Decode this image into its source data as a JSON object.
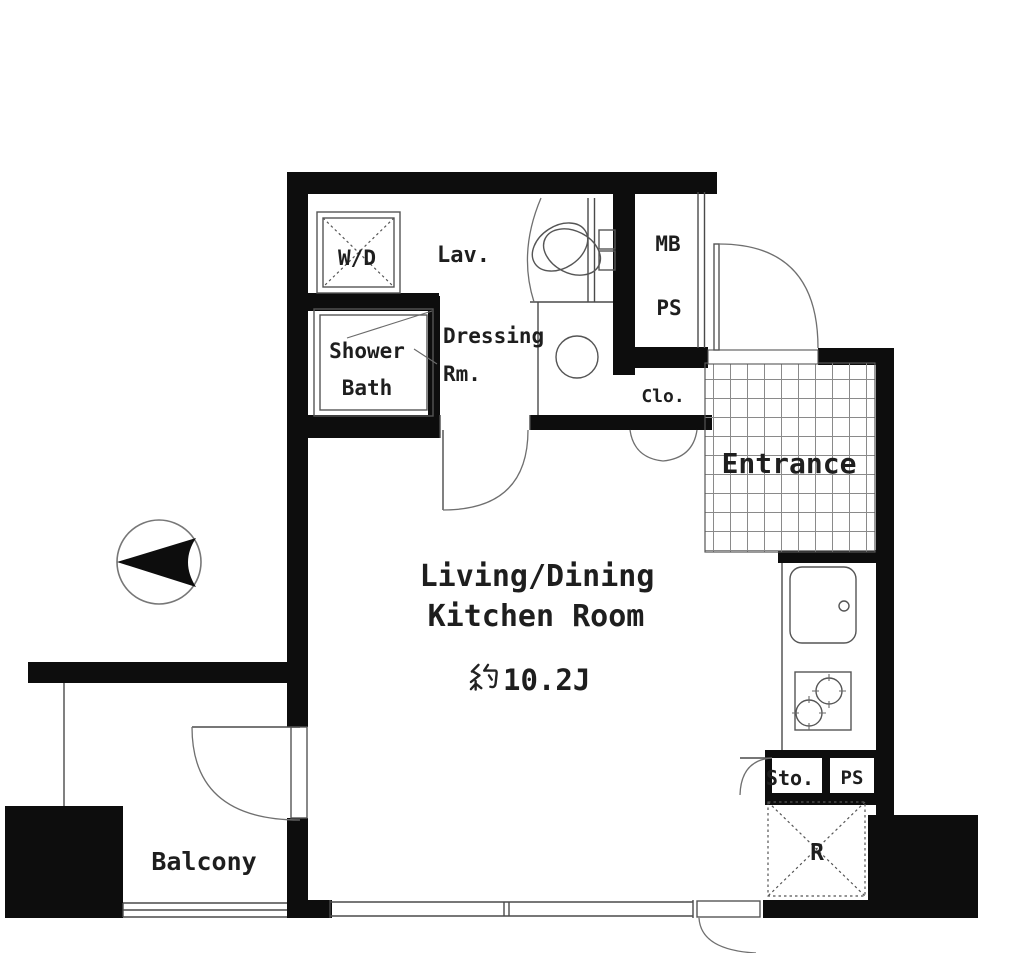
{
  "plan": {
    "title": "apartment-floor-plan",
    "rooms": {
      "wd": "W/D",
      "lav": "Lav.",
      "mb": "MB",
      "ps_upper": "PS",
      "shower_line1": "Shower",
      "shower_line2": "Bath",
      "dressing_line1": "Dressing",
      "dressing_line2": "Rm.",
      "closet": "Clo.",
      "entrance": "Entrance",
      "ldk_line1": "Living/Dining",
      "ldk_line2": "Kitchen Room",
      "ldk_area": "約10.2J",
      "ldk_area_suffix": "10.2J",
      "storage": "Sto.",
      "ps_lower": "PS",
      "refrigerator": "R",
      "balcony": "Balcony"
    },
    "colors": {
      "wall": "#0d0d0d",
      "line": "#4a4a4a",
      "text": "#1e1e1e",
      "background": "#ffffff"
    }
  }
}
